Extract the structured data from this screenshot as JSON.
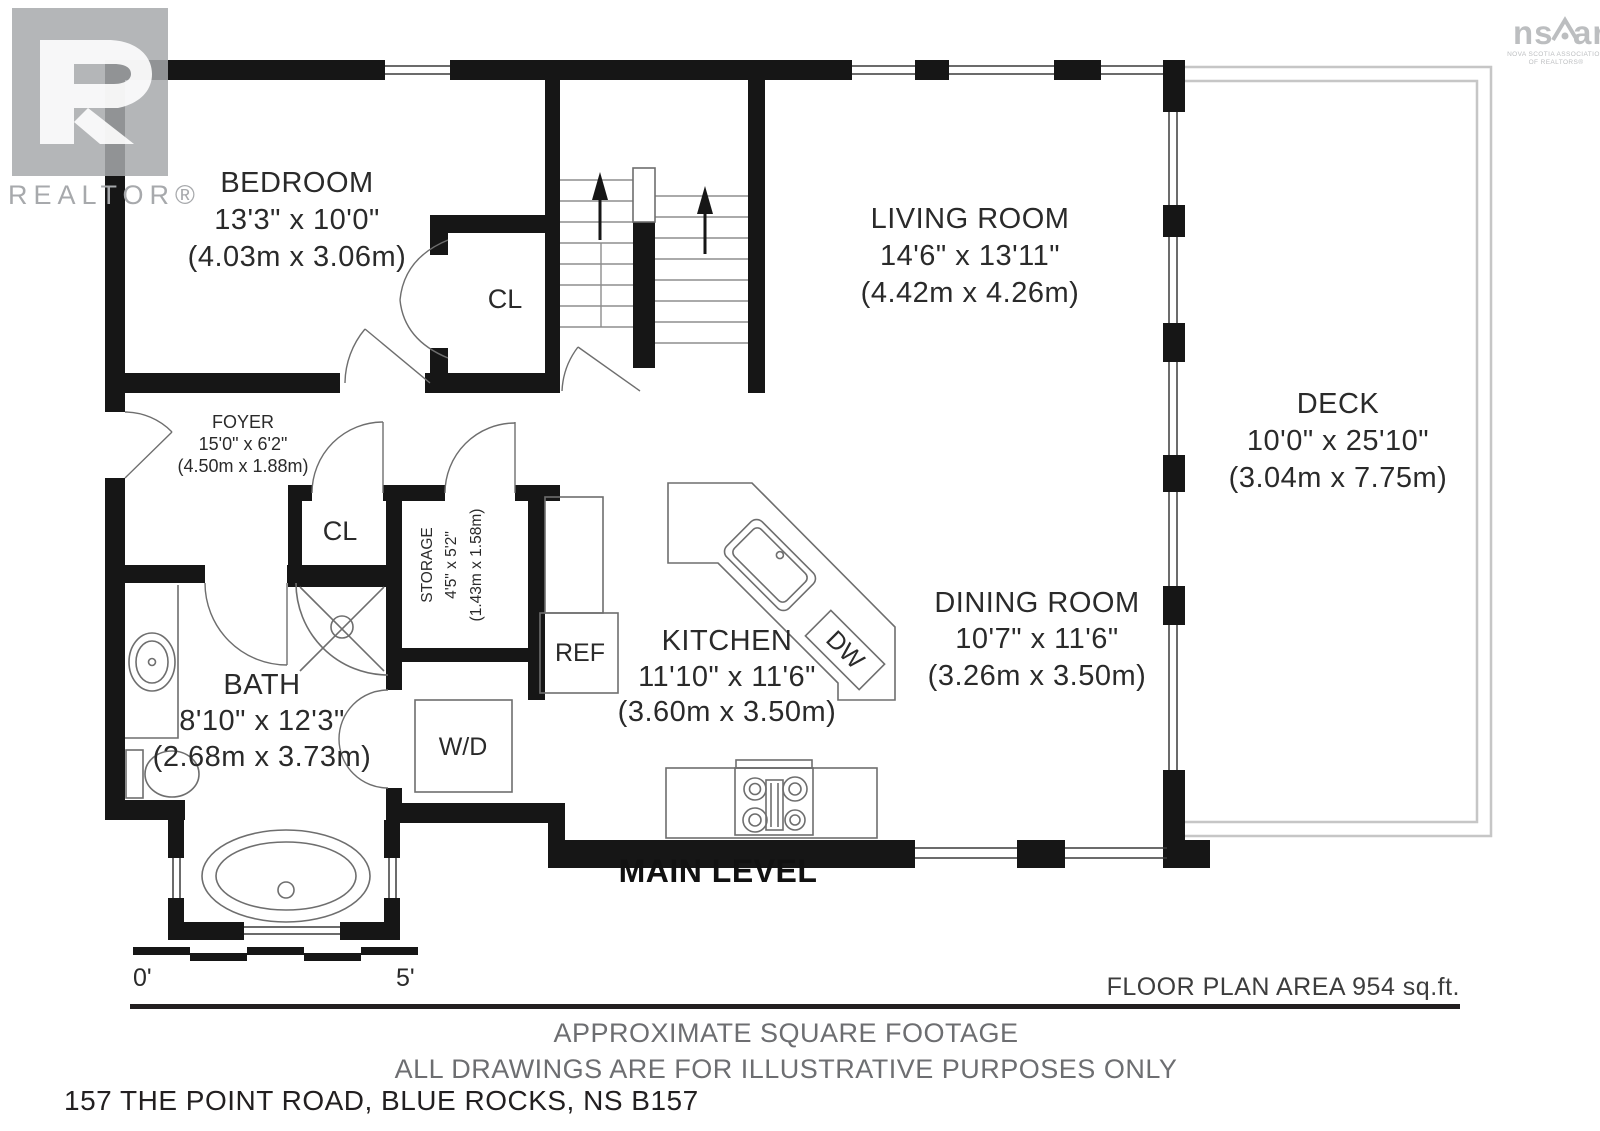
{
  "logos": {
    "realtor": {
      "label": "REALTOR®"
    },
    "nsar": {
      "part1": "ns",
      "part2": "ar",
      "sub1": "NOVA SCOTIA ASSOCIATION",
      "sub2": "OF REALTORS®"
    }
  },
  "plan": {
    "level_title": "MAIN LEVEL",
    "rooms": {
      "bedroom": {
        "name": "BEDROOM",
        "imperial": "13'3\" x 10'0\"",
        "metric": "(4.03m x 3.06m)"
      },
      "living": {
        "name": "LIVING ROOM",
        "imperial": "14'6\" x 13'11\"",
        "metric": "(4.42m x 4.26m)"
      },
      "deck": {
        "name": "DECK",
        "imperial": "10'0\" x 25'10\"",
        "metric": "(3.04m x 7.75m)"
      },
      "foyer": {
        "name": "FOYER",
        "imperial": "15'0\" x 6'2\"",
        "metric": "(4.50m x 1.88m)"
      },
      "storage": {
        "name": "STORAGE",
        "imperial": "4'5\" x 5'2\"",
        "metric": "(1.43m x 1.58m)"
      },
      "kitchen": {
        "name": "KITCHEN",
        "imperial": "11'10\" x 11'6\"",
        "metric": "(3.60m x 3.50m)"
      },
      "dining": {
        "name": "DINING ROOM",
        "imperial": "10'7\" x 11'6\"",
        "metric": "(3.26m x 3.50m)"
      },
      "bath": {
        "name": "BATH",
        "imperial": "8'10\" x 12'3\"",
        "metric": "(2.68m x 3.73m)"
      }
    },
    "fixtures": {
      "closet_bedroom": "CL",
      "closet_foyer": "CL",
      "fridge": "REF",
      "dishwasher": "DW",
      "washer_dryer": "W/D"
    },
    "scale": {
      "start": "0'",
      "end": "5'"
    }
  },
  "footer": {
    "area": "FLOOR PLAN AREA 954 sq.ft.",
    "note1": "APPROXIMATE SQUARE FOOTAGE",
    "note2": "ALL DRAWINGS ARE FOR ILLUSTRATIVE PURPOSES ONLY",
    "address": "157 THE POINT ROAD, BLUE ROCKS, NS B157"
  },
  "colors": {
    "wall": "#161616",
    "text_dark": "#2a2a2a",
    "text_gray": "#6d6e71",
    "logo_gray": "#a7a9ac",
    "nsar_gray": "#bcbec0"
  }
}
